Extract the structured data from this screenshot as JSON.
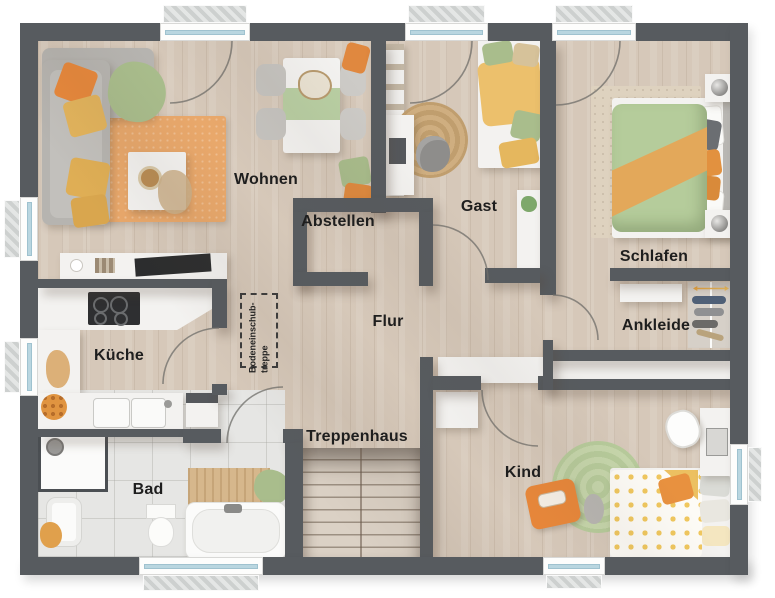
{
  "title": "Obergeschoss Grundriss",
  "rooms": [
    {
      "key": "wohnen",
      "label": "Wohnen"
    },
    {
      "key": "abstellen",
      "label": "Abstellen"
    },
    {
      "key": "gast",
      "label": "Gast"
    },
    {
      "key": "schlafen",
      "label": "Schlafen"
    },
    {
      "key": "kueche",
      "label": "Küche"
    },
    {
      "key": "flur",
      "label": "Flur"
    },
    {
      "key": "ankleide",
      "label": "Ankleide"
    },
    {
      "key": "bad",
      "label": "Bad"
    },
    {
      "key": "treppenhaus",
      "label": "Treppenhaus"
    },
    {
      "key": "kind",
      "label": "Kind"
    }
  ],
  "attic_hatch": {
    "line1": "Bodeneinschub-",
    "line2": "treppe"
  },
  "windows": {
    "top": 3,
    "left": 2,
    "bottom": 2,
    "right": 1
  },
  "colors": {
    "wall": "#575b5f",
    "wood_floor": "#d6c8b9",
    "tile_floor": "#e6e6e4",
    "rug_orange": "#e9a86b",
    "textile_green": "#a9bd8c",
    "textile_yellow": "#e5b75e",
    "textile_orange": "#e8883b",
    "window_glass": "#b9d6e0"
  }
}
